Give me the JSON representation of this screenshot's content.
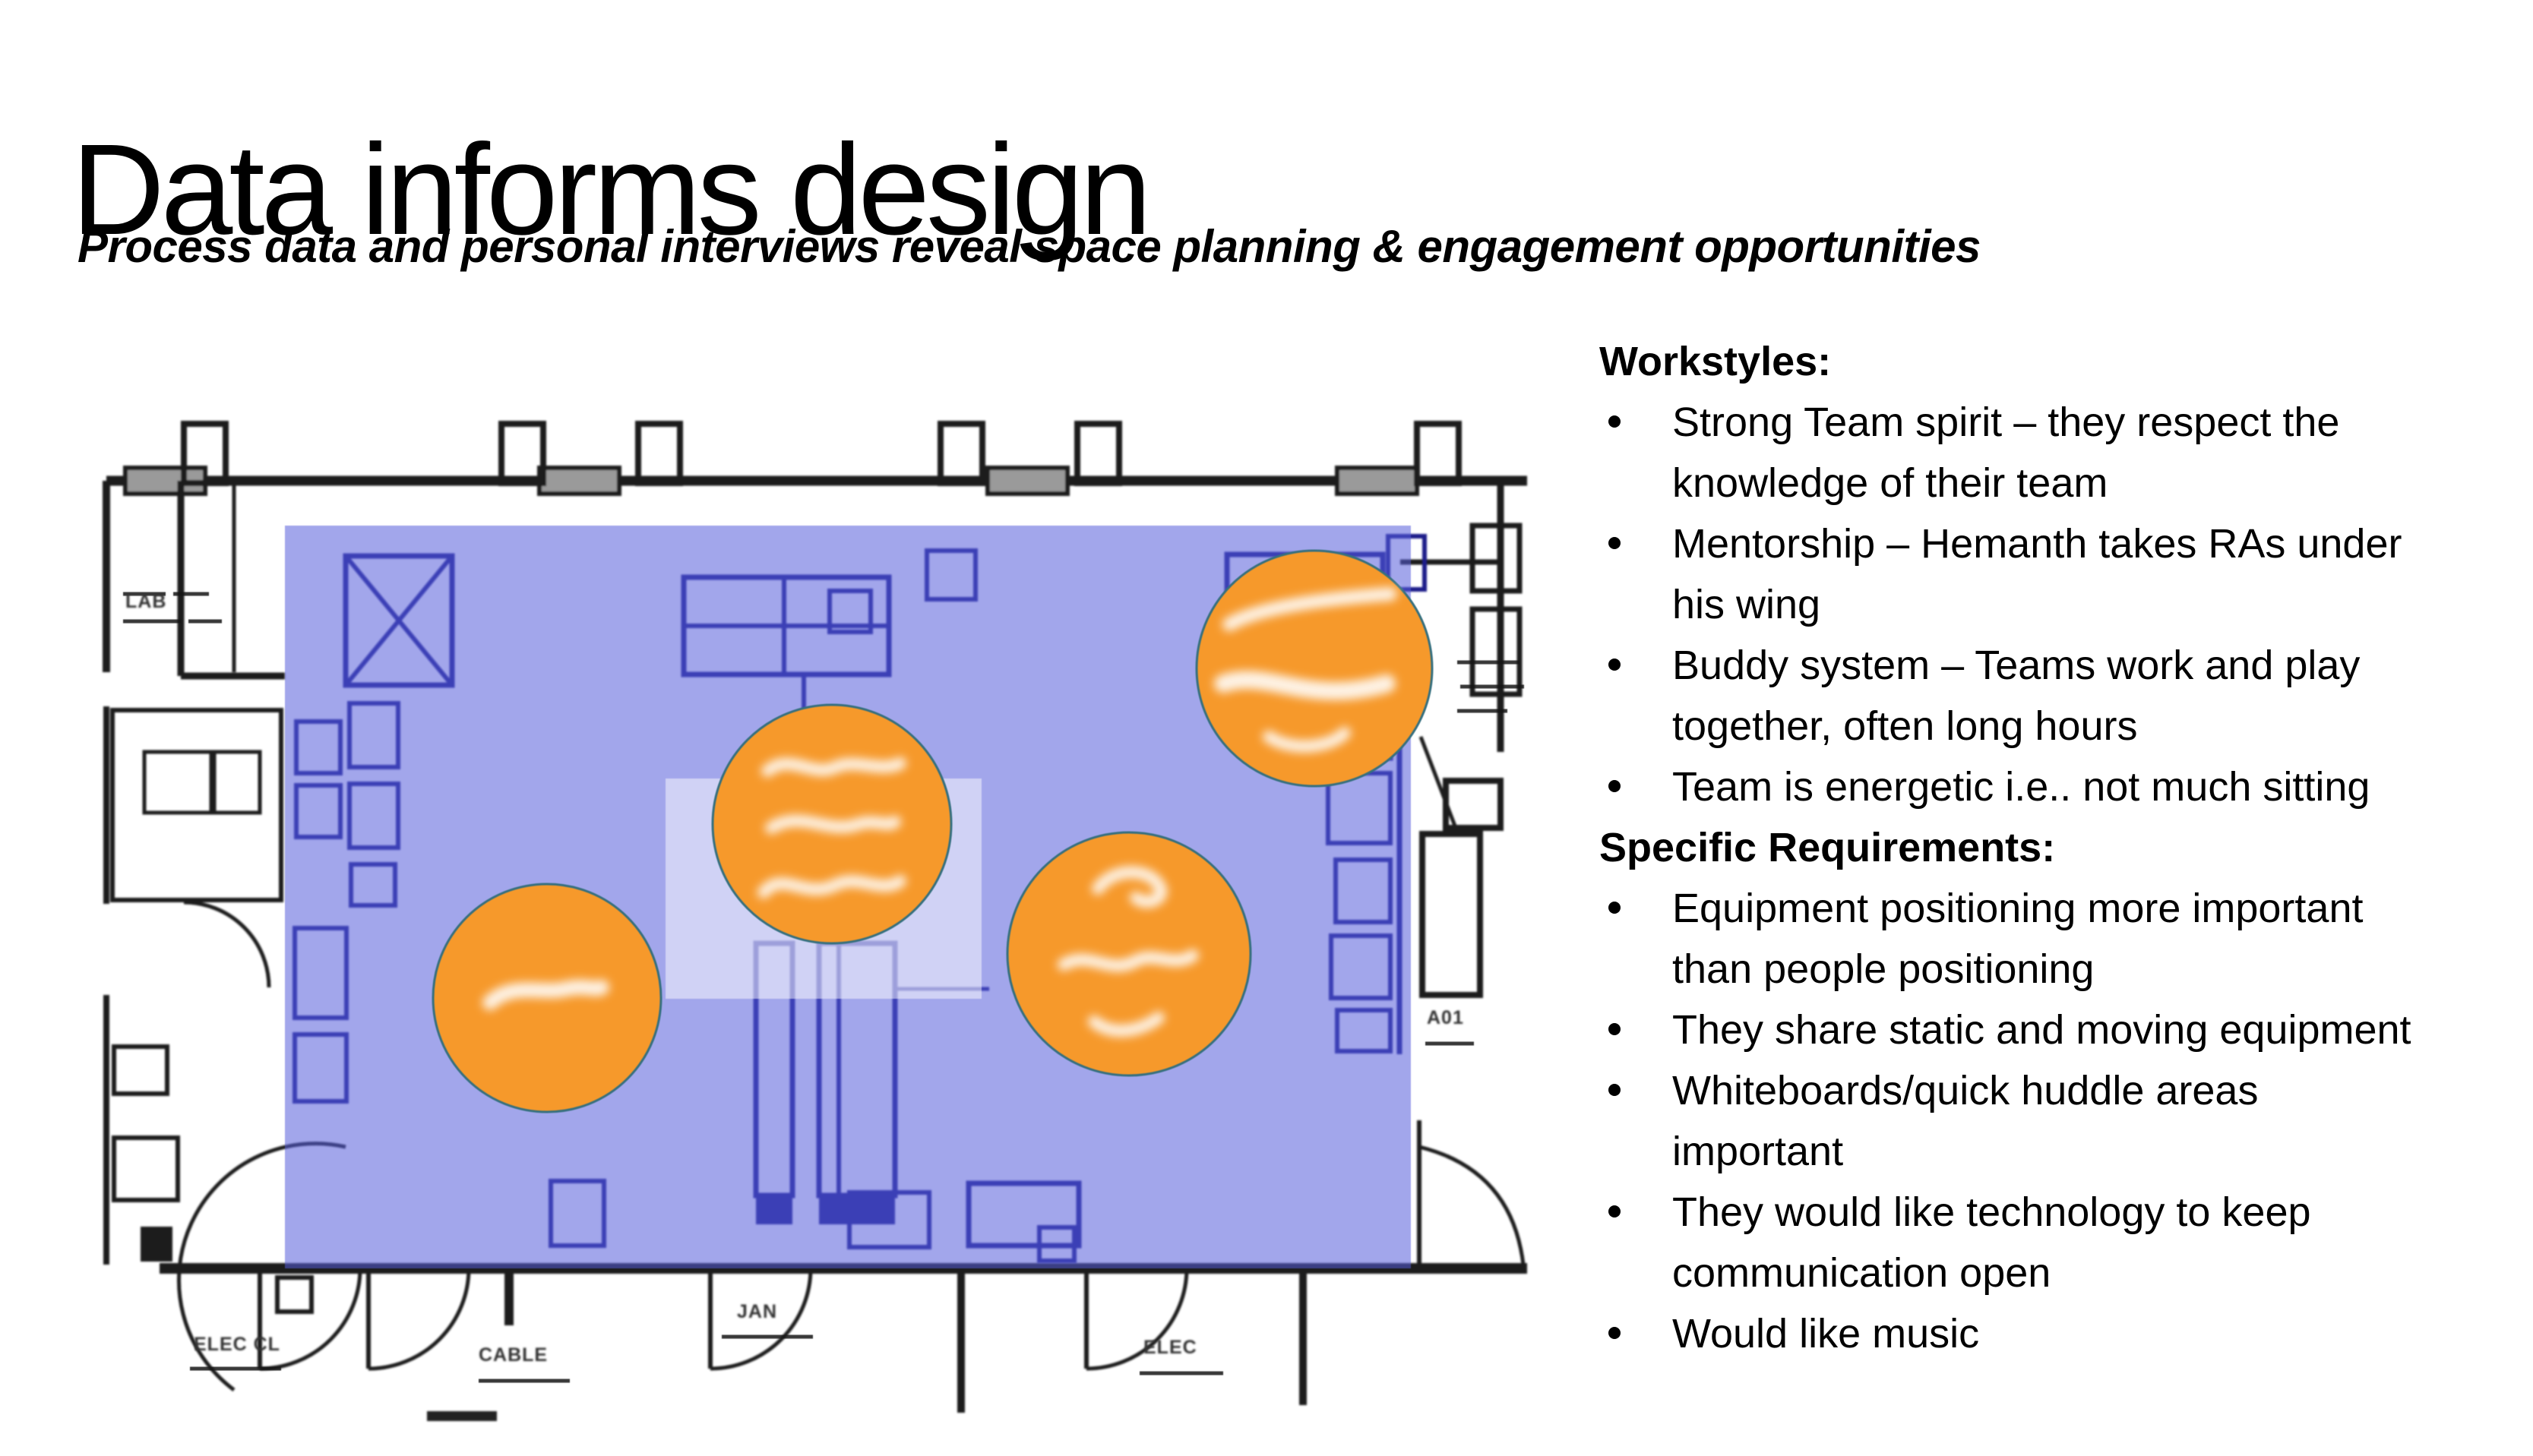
{
  "slide": {
    "title": "Data informs design",
    "subtitle": "Process data and personal interviews reveal space planning & engagement opportunities"
  },
  "right_panel": {
    "sections": [
      {
        "heading": "Workstyles:",
        "items": [
          {
            "lines": [
              "Strong Team spirit – they respect the",
              "knowledge of their team"
            ]
          },
          {
            "lines": [
              "Mentorship – Hemanth takes RAs under",
              "his wing"
            ]
          },
          {
            "lines": [
              "Buddy system – Teams work and play",
              "together, often long hours"
            ]
          },
          {
            "lines": [
              "Team is energetic i.e.. not much sitting"
            ]
          }
        ]
      },
      {
        "heading": "Specific Requirements:",
        "items": [
          {
            "lines": [
              "Equipment positioning more important",
              "than people positioning"
            ]
          },
          {
            "lines": [
              "They share static and moving equipment"
            ]
          },
          {
            "lines": [
              "Whiteboards/quick huddle areas",
              "important"
            ]
          },
          {
            "lines": [
              "They would like technology to keep",
              "communication open"
            ]
          },
          {
            "lines": [
              "Would like music"
            ]
          }
        ]
      }
    ]
  },
  "floor_plan": {
    "type": "scanned architectural floor plan with highlighted zone and handwritten annotation circles",
    "highlight_color": "#555cdb",
    "annotation_circle_color": "#f6992b",
    "annotation_circle_count": 4,
    "micro_labels": {
      "lab": "LAB",
      "elec_cl_left": "ELEC CL",
      "cable_mid": "CABLE",
      "jan": "JAN",
      "elec_right": "ELEC",
      "a01": "A01"
    }
  }
}
